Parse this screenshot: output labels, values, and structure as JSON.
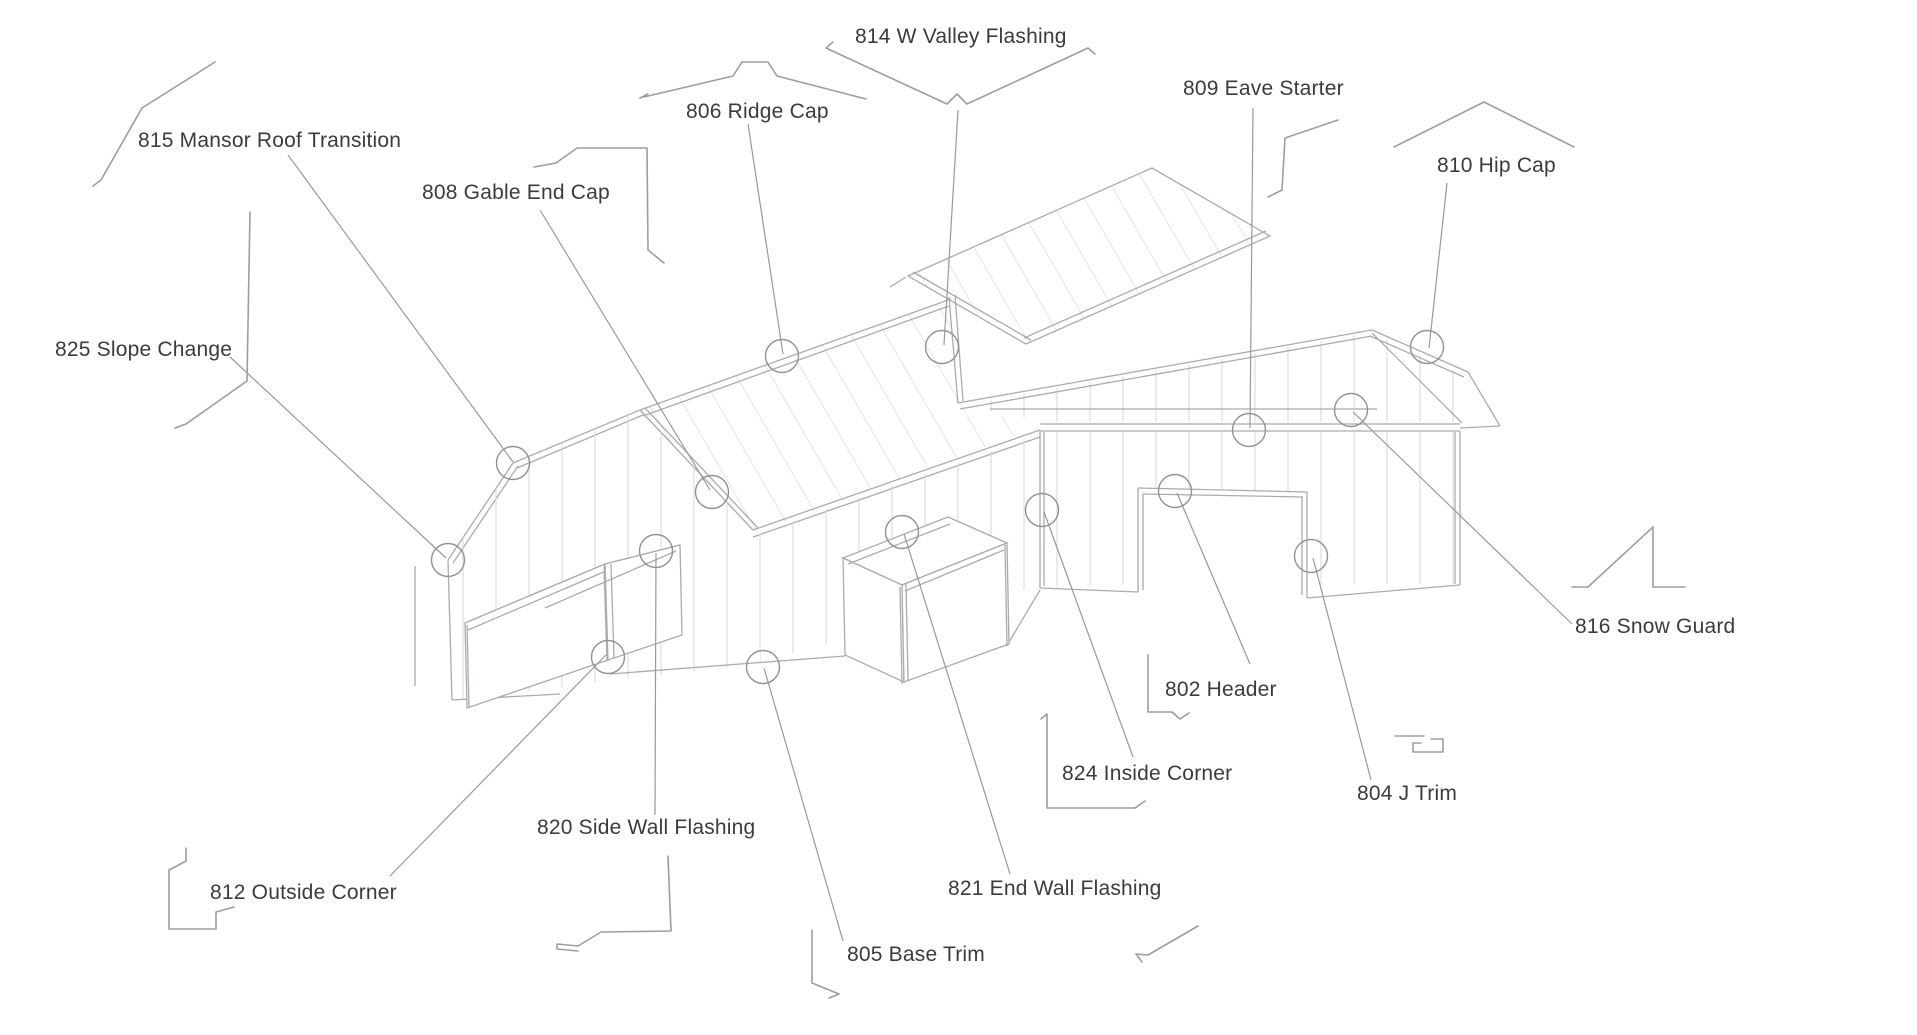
{
  "diagram_title": "Building trim and flashing locations (isometric callout diagram)",
  "colors": {
    "background": "#ffffff",
    "line_art": "#a8acaf",
    "panel_hatch": "#cdd1d4",
    "leader": "#97999b",
    "text": "#3b3b3b"
  },
  "labels": [
    {
      "code": "802",
      "name": "Header",
      "text": "802 Header",
      "icon": "header-profile-icon"
    },
    {
      "code": "804",
      "name": "J Trim",
      "text": "804 J Trim",
      "icon": "j-trim-profile-icon"
    },
    {
      "code": "805",
      "name": "Base Trim",
      "text": "805 Base Trim",
      "icon": "base-trim-profile-icon"
    },
    {
      "code": "806",
      "name": "Ridge Cap",
      "text": "806 Ridge Cap",
      "icon": "ridge-cap-profile-icon"
    },
    {
      "code": "808",
      "name": "Gable End Cap",
      "text": "808 Gable End Cap",
      "icon": "gable-end-cap-profile-icon"
    },
    {
      "code": "809",
      "name": "Eave Starter",
      "text": "809 Eave Starter",
      "icon": "eave-starter-profile-icon"
    },
    {
      "code": "810",
      "name": "Hip Cap",
      "text": "810 Hip Cap",
      "icon": "hip-cap-profile-icon"
    },
    {
      "code": "812",
      "name": "Outside Corner",
      "text": "812 Outside Corner",
      "icon": "outside-corner-profile-icon"
    },
    {
      "code": "814",
      "name": "W Valley Flashing",
      "text": "814 W Valley Flashing",
      "icon": "valley-flashing-profile-icon"
    },
    {
      "code": "815",
      "name": "Mansor Roof Transition",
      "text": "815 Mansor Roof Transition",
      "icon": "mansard-transition-profile-icon"
    },
    {
      "code": "816",
      "name": "Snow Guard",
      "text": "816 Snow Guard",
      "icon": "snow-guard-profile-icon"
    },
    {
      "code": "820",
      "name": "Side Wall Flashing",
      "text": "820 Side Wall Flashing",
      "icon": "side-wall-flashing-profile-icon"
    },
    {
      "code": "821",
      "name": "End Wall Flashing",
      "text": "821 End Wall Flashing",
      "icon": "end-wall-flashing-profile-icon"
    },
    {
      "code": "824",
      "name": "Inside Corner",
      "text": "824 Inside Corner",
      "icon": "inside-corner-profile-icon"
    },
    {
      "code": "825",
      "name": "Slope Change",
      "text": "825 Slope Change",
      "icon": "slope-change-profile-icon"
    }
  ]
}
